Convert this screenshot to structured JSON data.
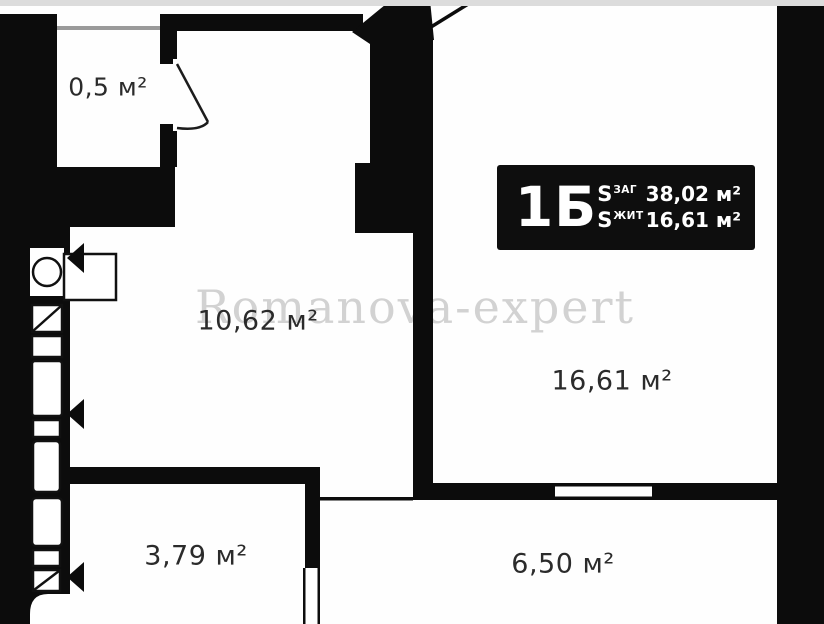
{
  "plan": {
    "watermark": "Romanova-expert",
    "rooms": [
      {
        "name": "storage",
        "area_label": "0,5 м²"
      },
      {
        "name": "hallway",
        "area_label": "10,62 м²"
      },
      {
        "name": "living-room",
        "area_label": "16,61 м²"
      },
      {
        "name": "bathroom",
        "area_label": "3,79 м²"
      },
      {
        "name": "kitchen",
        "area_label": "6,50 м²"
      }
    ],
    "info_box": {
      "unit_label": "1Б",
      "rows": [
        {
          "symbol": "S",
          "subscript": "ЗАГ",
          "value": "38,02 м²"
        },
        {
          "symbol": "S",
          "subscript": "ЖИТ",
          "value": "16,61 м²"
        }
      ]
    },
    "colors": {
      "wall": "#0c0c0c",
      "background": "#ffffff",
      "info_box_bg": "#0e0e0e",
      "info_box_fg": "#ffffff",
      "watermark": "#c4c4c4",
      "window_sill": "#9a9a9a"
    }
  }
}
